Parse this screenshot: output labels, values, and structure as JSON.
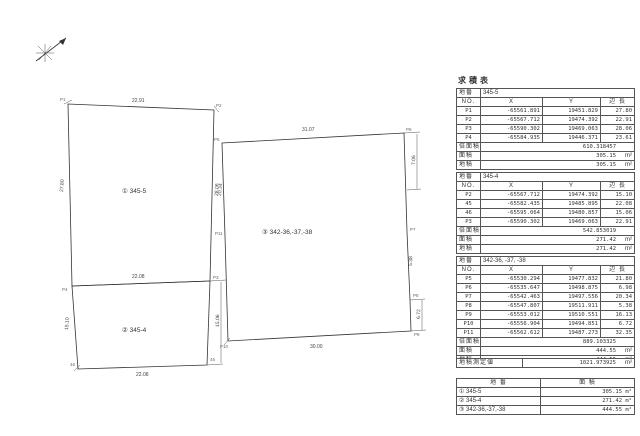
{
  "page": {
    "title": "求積表"
  },
  "drawing": {
    "north_label": "north-compass",
    "parcel1": {
      "label": "① 345-5",
      "dims": {
        "top": "22.91",
        "left": "27.80",
        "right": "28.06",
        "divider": "22.08"
      }
    },
    "parcel2": {
      "label": "② 345-4",
      "dims": {
        "left": "15.10",
        "right": "15.06",
        "bottom": "22.08"
      }
    },
    "parcel3": {
      "label": "③ 342-36,-37,-38",
      "dims": {
        "top": "31.07",
        "left": "20.34",
        "right_a": "7.06",
        "right_b": "5.38",
        "right_c": "6.72",
        "bottom": "30.00"
      }
    },
    "point_labels": [
      "P1",
      "P2",
      "P3",
      "P4",
      "45",
      "46",
      "P5",
      "P6",
      "P7",
      "P8",
      "P9",
      "P10",
      "P11"
    ]
  },
  "tables": [
    {
      "parcel_no_label": "地番",
      "parcel_no": "345-5",
      "headers": [
        "NO.",
        "X",
        "Y",
        "辺 長"
      ],
      "rows": [
        [
          "P1",
          "-65561.891",
          "19451.829",
          "27.80"
        ],
        [
          "P2",
          "-65567.712",
          "19474.392",
          "22.91"
        ],
        [
          "P3",
          "-65590.302",
          "19469.063",
          "28.06"
        ],
        [
          "P4",
          "-65584.935",
          "19446.371",
          "23.61"
        ]
      ],
      "footers": [
        {
          "label": "倍面積",
          "value": "610.318457",
          "unit": ""
        },
        {
          "label": "面積",
          "value": "305.15",
          "unit": "m²"
        },
        {
          "label": "地積",
          "value": "305.15",
          "unit": "m²"
        }
      ]
    },
    {
      "parcel_no_label": "地番",
      "parcel_no": "345-4",
      "headers": [
        "NO.",
        "X",
        "Y",
        "辺 長"
      ],
      "rows": [
        [
          "P2",
          "-65567.712",
          "19474.392",
          "15.10"
        ],
        [
          "45",
          "-65582.435",
          "19485.895",
          "22.08"
        ],
        [
          "46",
          "-65595.064",
          "19480.857",
          "15.06"
        ],
        [
          "P3",
          "-65590.302",
          "19469.063",
          "22.91"
        ]
      ],
      "footers": [
        {
          "label": "倍面積",
          "value": "542.853019",
          "unit": ""
        },
        {
          "label": "面積",
          "value": "271.42",
          "unit": "m²"
        },
        {
          "label": "地積",
          "value": "271.42",
          "unit": "m²"
        }
      ]
    },
    {
      "parcel_no_label": "地番",
      "parcel_no": "342-36, -37, -38",
      "headers": [
        "NO.",
        "X",
        "Y",
        "辺 長"
      ],
      "rows": [
        [
          "P5",
          "-65530.294",
          "19477.832",
          "21.80"
        ],
        [
          "P6",
          "-65535.647",
          "19498.875",
          "6.98"
        ],
        [
          "P7",
          "-65542.463",
          "19497.556",
          "20.34"
        ],
        [
          "P8",
          "-65547.807",
          "19511.911",
          "5.38"
        ],
        [
          "P9",
          "-65553.012",
          "19510.551",
          "16.13"
        ],
        [
          "P10",
          "-65556.904",
          "19494.851",
          "6.72"
        ],
        [
          "P11",
          "-65562.612",
          "19487.273",
          "32.35"
        ]
      ],
      "footers": [
        {
          "label": "倍面積",
          "value": "889.103325",
          "unit": ""
        },
        {
          "label": "面積",
          "value": "444.55",
          "unit": "m²"
        },
        {
          "label": "地積",
          "value": "444.55",
          "unit": "m²"
        }
      ]
    }
  ],
  "total_row": {
    "label": "地積測定値",
    "value": "1021.973925",
    "unit": "m²"
  },
  "summary": {
    "headers": [
      "地 番",
      "面 積"
    ],
    "rows": [
      {
        "parcel": "① 345-5",
        "area": "305.15 m²"
      },
      {
        "parcel": "② 345-4",
        "area": "271.42 m²"
      },
      {
        "parcel": "③ 342-36,-37,-38",
        "area": "444.55 m²"
      }
    ]
  }
}
